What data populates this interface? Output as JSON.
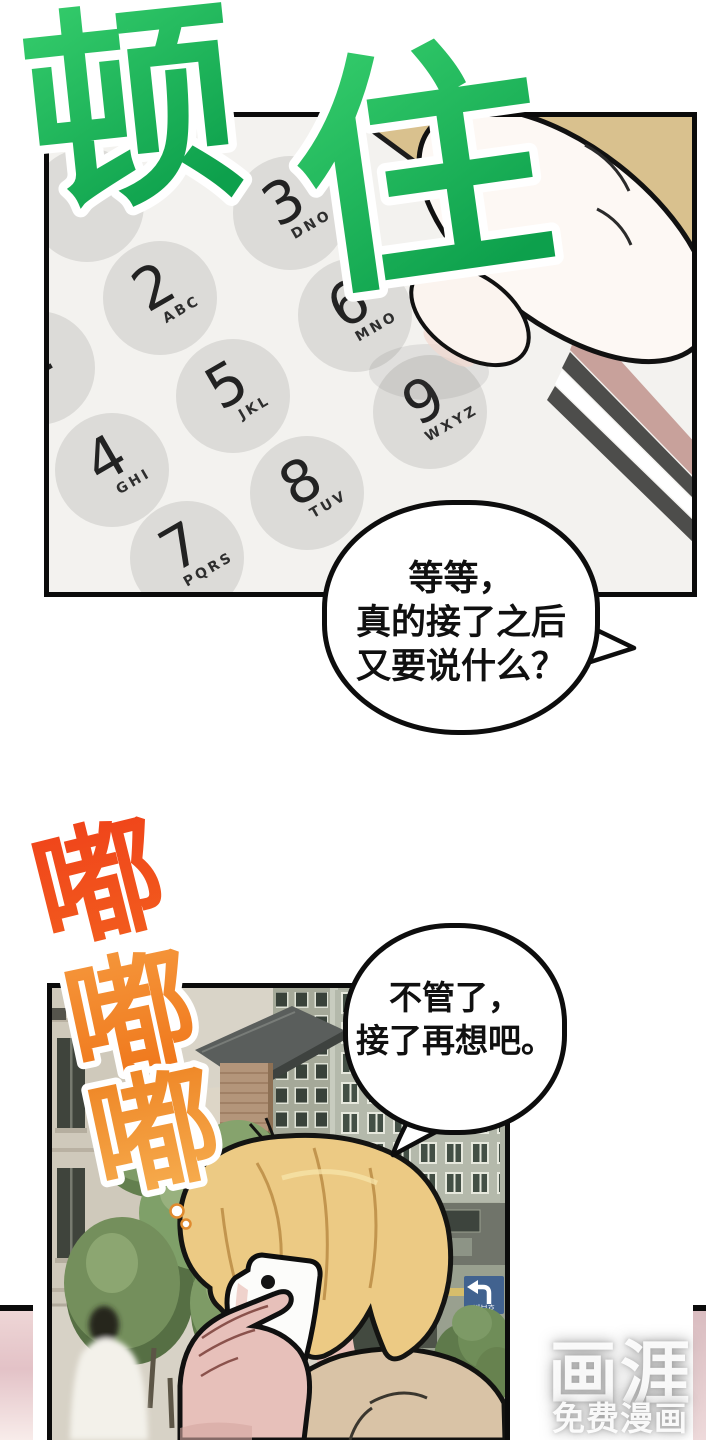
{
  "page": {
    "background": "#ffffff"
  },
  "sfx_freeze": {
    "char1": "顿",
    "char2": "住",
    "color_top": "#38d06e",
    "color_bottom": "#0da04c"
  },
  "sfx_ring": {
    "char1": "嘟",
    "char2": "嘟",
    "char3": "嘟",
    "c1_top": "#f0431a",
    "c1_bottom": "#f25e1e",
    "c2_top": "#f5973c",
    "c2_bottom": "#ef7418",
    "c3_top": "#ee8424",
    "c3_bottom": "#f7b052"
  },
  "keypad": {
    "panel_bg": "#f3f2ef",
    "key_color": "#dcdbd8",
    "keys": [
      {
        "digit": "1",
        "letters": ""
      },
      {
        "digit": "2",
        "letters": "ABC"
      },
      {
        "digit": "3",
        "letters": "DNO"
      },
      {
        "digit": "4",
        "letters": "GHI"
      },
      {
        "digit": "5",
        "letters": "JKL"
      },
      {
        "digit": "6",
        "letters": "MNO"
      },
      {
        "digit": "7",
        "letters": "PQRS"
      },
      {
        "digit": "8",
        "letters": "TUV"
      },
      {
        "digit": "9",
        "letters": "WXYZ"
      }
    ]
  },
  "speech": {
    "bubble1_line1": "等等，",
    "bubble1_line2": "真的接了之后",
    "bubble1_line3": "又要说什么？",
    "bubble2_line1": "不管了，",
    "bubble2_line2": "接了再想吧。"
  },
  "street_sign": {
    "label": "비보호",
    "color": "#41628f"
  },
  "scene_colors": {
    "hair": "#ecca84",
    "coat": "#d9c3a6",
    "tree": "#7e9b66",
    "phone_case_pink": "#c8a19b",
    "table_tan": "#d9c18e"
  },
  "watermark": {
    "logo": "画涯",
    "tagline": "免费漫画"
  }
}
